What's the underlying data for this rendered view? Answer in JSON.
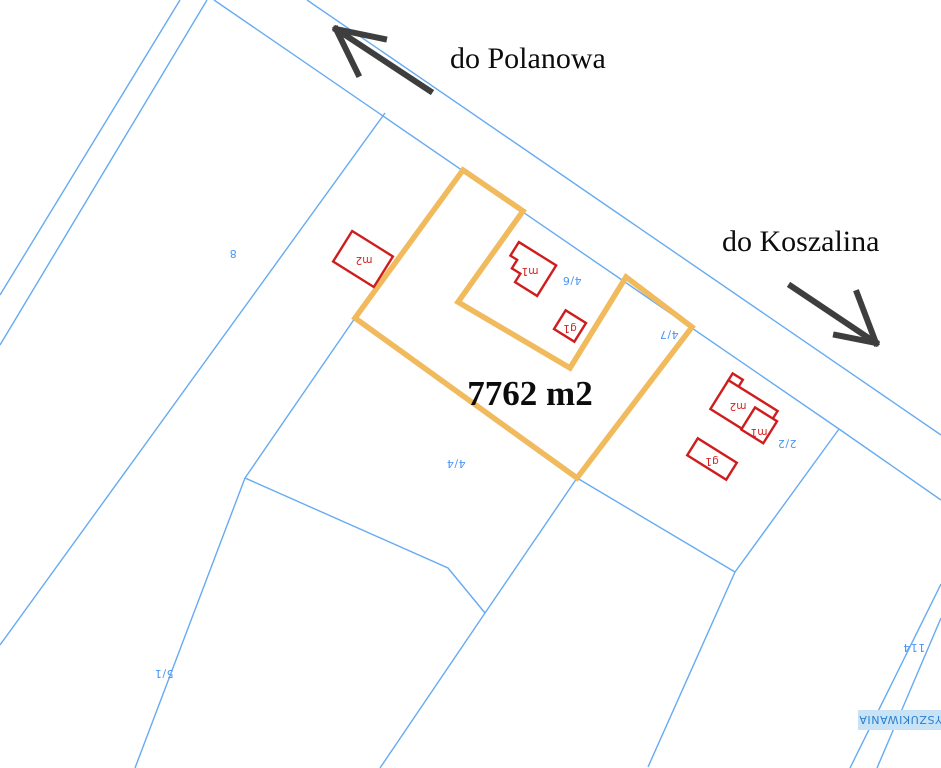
{
  "map": {
    "type": "cadastral-plot-map",
    "labels": {
      "direction_north": "do Polanowa",
      "direction_east": "do Koszalina",
      "area": "7762 m2",
      "badge": "WYSZUKIWANIA"
    },
    "parcels": [
      {
        "label": "8"
      },
      {
        "label": "4/6"
      },
      {
        "label": "4/7"
      },
      {
        "label": "4/4"
      },
      {
        "label": "2/2"
      },
      {
        "label": "5/1"
      },
      {
        "label": "114"
      }
    ],
    "buildings": [
      {
        "label": "m2"
      },
      {
        "label": "m1"
      },
      {
        "label": "g1"
      },
      {
        "label": "m2"
      },
      {
        "label": "m1"
      },
      {
        "label": "g1"
      }
    ],
    "colors": {
      "boundary_blue": "#66abf2",
      "parcel_text_blue": "#4b96f5",
      "plot_outline_orange": "#f1ba5d",
      "building_red": "#cf1d1d",
      "arrow_gray": "#3e3e3e",
      "badge_background": "#c7e3f5",
      "badge_text": "#2b7fd0",
      "background": "#ffffff"
    }
  }
}
